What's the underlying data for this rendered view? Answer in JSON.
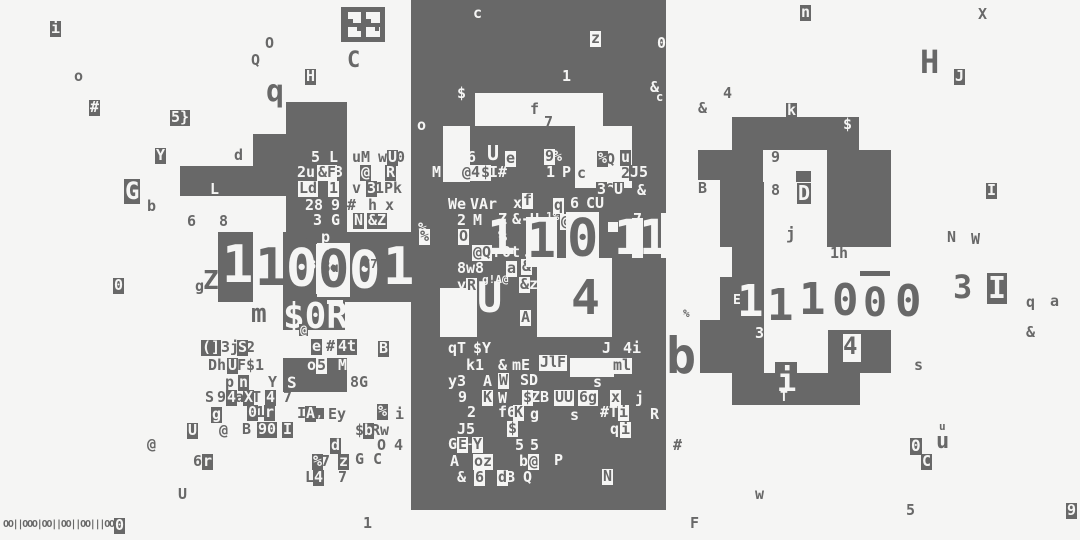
{
  "title": "glitch-terminal-art",
  "colors": {
    "ink": "#686868",
    "paper": "#f5f5f4"
  },
  "barcode": {
    "text": "OO||OOO|OO||OO||OO|||OOO"
  },
  "blocks": [
    [
      341,
      7,
      44,
      35
    ],
    [
      286,
      102,
      61,
      130
    ],
    [
      253,
      134,
      33,
      62
    ],
    [
      180,
      166,
      103,
      30
    ],
    [
      218,
      232,
      35,
      70
    ],
    [
      283,
      232,
      137,
      70
    ],
    [
      283,
      302,
      62,
      28
    ],
    [
      283,
      358,
      64,
      34
    ],
    [
      411,
      0,
      255,
      510
    ],
    [
      732,
      117,
      127,
      33
    ],
    [
      720,
      150,
      43,
      32
    ],
    [
      827,
      150,
      64,
      32
    ],
    [
      796,
      171,
      15,
      11
    ],
    [
      720,
      182,
      44,
      120
    ],
    [
      827,
      182,
      64,
      65
    ],
    [
      734,
      278,
      29,
      46
    ],
    [
      720,
      302,
      44,
      71
    ],
    [
      828,
      330,
      63,
      43
    ],
    [
      732,
      373,
      128,
      32
    ],
    [
      700,
      320,
      32,
      53
    ],
    [
      698,
      150,
      22,
      30
    ],
    [
      860,
      271,
      30,
      5
    ],
    [
      775,
      362,
      22,
      14
    ]
  ],
  "lights": [
    [
      348,
      12,
      13,
      11
    ],
    [
      366,
      12,
      14,
      11
    ],
    [
      348,
      27,
      13,
      10
    ],
    [
      366,
      27,
      14,
      10
    ],
    [
      316,
      244,
      28,
      50
    ],
    [
      327,
      300,
      16,
      4
    ],
    [
      475,
      93,
      128,
      33
    ],
    [
      443,
      126,
      27,
      56
    ],
    [
      575,
      126,
      57,
      62
    ],
    [
      440,
      288,
      37,
      49
    ],
    [
      537,
      258,
      75,
      79
    ],
    [
      632,
      218,
      11,
      40
    ],
    [
      608,
      222,
      10,
      10
    ],
    [
      570,
      358,
      44,
      19
    ],
    [
      661,
      213,
      6,
      45
    ],
    [
      720,
      247,
      12,
      30
    ],
    [
      843,
      334,
      18,
      28
    ]
  ],
  "overblocks": [
    [
      348,
      19,
      5,
      4
    ],
    [
      366,
      19,
      5,
      4
    ],
    [
      357,
      27,
      4,
      4
    ],
    [
      375,
      27,
      4,
      4
    ]
  ],
  "glyphs": [
    [
      50,
      21,
      "i",
      "i"
    ],
    [
      74,
      69,
      "o",
      "d"
    ],
    [
      89,
      100,
      "#",
      "i"
    ],
    [
      170,
      110,
      "5}",
      "i"
    ],
    [
      155,
      148,
      "Y",
      "i"
    ],
    [
      124,
      179,
      "G",
      "i",
      24
    ],
    [
      147,
      199,
      "b",
      "d"
    ],
    [
      234,
      148,
      "d",
      "d"
    ],
    [
      187,
      214,
      "6",
      "d"
    ],
    [
      219,
      214,
      "8",
      "d"
    ],
    [
      265,
      36,
      "O",
      "d"
    ],
    [
      251,
      53,
      "Q",
      "d"
    ],
    [
      305,
      69,
      "H",
      "i"
    ],
    [
      266,
      76,
      "q",
      "d",
      30
    ],
    [
      347,
      50,
      "C",
      "d",
      22
    ],
    [
      113,
      278,
      "0",
      "i"
    ],
    [
      195,
      279,
      "g",
      "d"
    ],
    [
      203,
      268,
      "Z",
      "d",
      26
    ],
    [
      219,
      295,
      "'",
      "d",
      18
    ],
    [
      251,
      301,
      "m",
      "d",
      26
    ],
    [
      201,
      340,
      "(]",
      "i"
    ],
    [
      221,
      340,
      "3j",
      "d"
    ],
    [
      237,
      340,
      "S",
      "i"
    ],
    [
      246,
      340,
      "2",
      "d"
    ],
    [
      311,
      339,
      "e",
      "i"
    ],
    [
      326,
      339,
      "#",
      "d"
    ],
    [
      337,
      339,
      "4t",
      "i"
    ],
    [
      208,
      358,
      "Dh",
      "d"
    ],
    [
      227,
      358,
      "U",
      "i"
    ],
    [
      237,
      358,
      "F$1",
      "d"
    ],
    [
      225,
      375,
      "p",
      "d"
    ],
    [
      238,
      375,
      "n",
      "i"
    ],
    [
      268,
      375,
      "Y",
      "d"
    ],
    [
      205,
      390,
      "S",
      "d"
    ],
    [
      217,
      390,
      "9",
      "d"
    ],
    [
      226,
      390,
      "4",
      "i"
    ],
    [
      235,
      390,
      "a",
      "d"
    ],
    [
      243,
      390,
      "X",
      "i"
    ],
    [
      252,
      390,
      "T",
      "d"
    ],
    [
      265,
      390,
      "4",
      "i"
    ],
    [
      283,
      390,
      "7",
      "d"
    ],
    [
      211,
      407,
      "g",
      "i"
    ],
    [
      247,
      405,
      "0",
      "i"
    ],
    [
      256,
      405,
      "1",
      "d"
    ],
    [
      264,
      405,
      "r",
      "i"
    ],
    [
      297,
      406,
      "I",
      "d"
    ],
    [
      305,
      406,
      "A",
      "i"
    ],
    [
      315,
      408,
      ",",
      "i",
      11
    ],
    [
      328,
      407,
      "Ey",
      "d"
    ],
    [
      377,
      404,
      "%",
      "i"
    ],
    [
      395,
      407,
      "i",
      "d"
    ],
    [
      187,
      423,
      "U",
      "i"
    ],
    [
      219,
      423,
      "@",
      "d"
    ],
    [
      242,
      422,
      "B",
      "d"
    ],
    [
      257,
      422,
      "90",
      "i"
    ],
    [
      282,
      422,
      "I",
      "i"
    ],
    [
      355,
      423,
      "$",
      "d"
    ],
    [
      363,
      423,
      "b",
      "i"
    ],
    [
      371,
      423,
      "Rw",
      "d"
    ],
    [
      147,
      437,
      "@",
      "d"
    ],
    [
      330,
      438,
      "d",
      "i"
    ],
    [
      377,
      438,
      "O",
      "d"
    ],
    [
      394,
      438,
      "4",
      "d"
    ],
    [
      193,
      454,
      "6",
      "d"
    ],
    [
      202,
      454,
      "r",
      "i"
    ],
    [
      312,
      454,
      "%",
      "i"
    ],
    [
      321,
      454,
      "7",
      "d"
    ],
    [
      338,
      454,
      "z",
      "i"
    ],
    [
      355,
      452,
      "G",
      "d"
    ],
    [
      373,
      452,
      "C",
      "d"
    ],
    [
      305,
      470,
      "L",
      "d"
    ],
    [
      313,
      470,
      "4",
      "i"
    ],
    [
      338,
      470,
      "7",
      "d"
    ],
    [
      178,
      487,
      "U",
      "d"
    ],
    [
      363,
      516,
      "1",
      "d"
    ],
    [
      690,
      516,
      "F",
      "d"
    ],
    [
      114,
      518,
      "0",
      "i"
    ],
    [
      307,
      358,
      "o",
      "w"
    ],
    [
      316,
      358,
      "5",
      "b"
    ],
    [
      338,
      358,
      "M",
      "w"
    ],
    [
      287,
      375,
      "S",
      "w",
      16
    ],
    [
      350,
      375,
      "8G",
      "d"
    ],
    [
      378,
      341,
      "B",
      "i"
    ],
    [
      210,
      182,
      "L",
      "w"
    ],
    [
      311,
      150,
      "5 L",
      "w"
    ],
    [
      352,
      150,
      "uM",
      "d"
    ],
    [
      378,
      150,
      "w",
      "d"
    ],
    [
      387,
      150,
      "U",
      "i"
    ],
    [
      396,
      150,
      "0",
      "d"
    ],
    [
      297,
      165,
      "2u",
      "w"
    ],
    [
      317,
      165,
      "&F",
      "b"
    ],
    [
      334,
      165,
      "3",
      "w"
    ],
    [
      360,
      165,
      "@",
      "i"
    ],
    [
      385,
      165,
      "R",
      "i"
    ],
    [
      298,
      181,
      "Ld",
      "b"
    ],
    [
      328,
      181,
      "1",
      "b"
    ],
    [
      352,
      181,
      "v",
      "d"
    ],
    [
      366,
      181,
      "3",
      "i"
    ],
    [
      375,
      181,
      "1Pk",
      "d"
    ],
    [
      305,
      198,
      "28",
      "w"
    ],
    [
      331,
      198,
      "9",
      "w"
    ],
    [
      347,
      198,
      "#",
      "d"
    ],
    [
      368,
      198,
      "h",
      "d"
    ],
    [
      385,
      198,
      "x",
      "d"
    ],
    [
      313,
      213,
      "3",
      "w"
    ],
    [
      331,
      213,
      "G",
      "w"
    ],
    [
      353,
      213,
      "N",
      "i"
    ],
    [
      367,
      213,
      "&Z",
      "i"
    ],
    [
      303,
      229,
      "b",
      "d"
    ],
    [
      320,
      230,
      "p",
      "i"
    ],
    [
      393,
      230,
      "c",
      "d"
    ],
    [
      417,
      221,
      "%",
      "i"
    ],
    [
      222,
      238,
      "1",
      "w",
      52
    ],
    [
      255,
      241,
      "1",
      "d",
      52
    ],
    [
      286,
      242,
      "0",
      "w",
      52
    ],
    [
      317,
      243,
      "0",
      "b",
      52
    ],
    [
      349,
      244,
      "0",
      "w",
      52
    ],
    [
      383,
      240,
      "1",
      "w",
      52
    ],
    [
      318,
      247,
      "c\"",
      "w",
      10
    ],
    [
      309,
      259,
      "3",
      "w",
      12
    ],
    [
      321,
      259,
      "8",
      "d",
      16
    ],
    [
      331,
      262,
      "u",
      "d",
      13
    ],
    [
      363,
      258,
      "C7",
      "d",
      12
    ],
    [
      283,
      298,
      "$0R",
      "w",
      36
    ],
    [
      299,
      324,
      "@",
      "i",
      12
    ],
    [
      473,
      6,
      "c",
      "w"
    ],
    [
      590,
      31,
      "z",
      "b"
    ],
    [
      657,
      36,
      "0",
      "w"
    ],
    [
      562,
      69,
      "1",
      "w"
    ],
    [
      457,
      86,
      "$",
      "w"
    ],
    [
      650,
      80,
      "&",
      "w"
    ],
    [
      656,
      91,
      "c",
      "w",
      12
    ],
    [
      530,
      102,
      "f",
      "d"
    ],
    [
      544,
      115,
      "7",
      "d"
    ],
    [
      417,
      118,
      "o",
      "w"
    ],
    [
      432,
      165,
      "M",
      "w"
    ],
    [
      467,
      150,
      "6",
      "w"
    ],
    [
      487,
      143,
      "U",
      "w",
      20
    ],
    [
      505,
      151,
      "e",
      "b"
    ],
    [
      461,
      165,
      "@4",
      "b"
    ],
    [
      480,
      165,
      "$",
      "b"
    ],
    [
      489,
      165,
      "I#",
      "w"
    ],
    [
      544,
      149,
      "9",
      "b"
    ],
    [
      553,
      149,
      "%",
      "w"
    ],
    [
      546,
      165,
      "1",
      "w"
    ],
    [
      562,
      165,
      "P",
      "w"
    ],
    [
      577,
      166,
      "c",
      "d"
    ],
    [
      597,
      151,
      "%",
      "i"
    ],
    [
      606,
      152,
      "Q",
      "d"
    ],
    [
      620,
      150,
      "u",
      "i"
    ],
    [
      621,
      166,
      "2",
      "d"
    ],
    [
      629,
      165,
      "J",
      "i"
    ],
    [
      638,
      165,
      "5",
      "i"
    ],
    [
      596,
      182,
      "3",
      "i"
    ],
    [
      605,
      182,
      "6",
      "d"
    ],
    [
      613,
      182,
      "U",
      "i"
    ],
    [
      637,
      183,
      "&",
      "w"
    ],
    [
      698,
      181,
      "B",
      "d"
    ],
    [
      448,
      197,
      "We",
      "w"
    ],
    [
      470,
      197,
      "VAr",
      "w"
    ],
    [
      513,
      196,
      "x",
      "w"
    ],
    [
      522,
      193,
      "f",
      "b"
    ],
    [
      553,
      198,
      "q",
      "b"
    ],
    [
      570,
      196,
      "6",
      "w"
    ],
    [
      585,
      196,
      "C",
      "i"
    ],
    [
      594,
      196,
      "U",
      "i"
    ],
    [
      604,
      193,
      "N",
      "d",
      12
    ],
    [
      457,
      213,
      "2",
      "w"
    ],
    [
      473,
      213,
      "M",
      "w"
    ],
    [
      498,
      212,
      "Z",
      "w"
    ],
    [
      512,
      212,
      "&-U",
      "w"
    ],
    [
      546,
      211,
      "1%",
      "w",
      11
    ],
    [
      560,
      214,
      "@",
      "b"
    ],
    [
      633,
      212,
      "7",
      "w"
    ],
    [
      458,
      229,
      "O",
      "b"
    ],
    [
      498,
      229,
      "%",
      "w"
    ],
    [
      528,
      228,
      "Z",
      "b"
    ],
    [
      419,
      229,
      "%",
      "b"
    ],
    [
      472,
      245,
      "@Q",
      "b"
    ],
    [
      493,
      245,
      "r0t",
      "w"
    ],
    [
      523,
      248,
      "-",
      "w"
    ],
    [
      537,
      244,
      "k",
      "w"
    ],
    [
      457,
      261,
      "8w8",
      "w"
    ],
    [
      506,
      261,
      "a",
      "b"
    ],
    [
      521,
      259,
      "&",
      "b"
    ],
    [
      457,
      278,
      "y",
      "w"
    ],
    [
      466,
      278,
      "R",
      "b"
    ],
    [
      482,
      274,
      "g!A@",
      "w",
      11
    ],
    [
      519,
      277,
      "&",
      "b"
    ],
    [
      529,
      277,
      "z9",
      "w"
    ],
    [
      520,
      310,
      "A",
      "b"
    ],
    [
      477,
      276,
      "U",
      "w",
      42
    ],
    [
      487,
      214,
      "1",
      "w",
      48
    ],
    [
      526,
      217,
      "1",
      "b",
      48
    ],
    [
      566,
      212,
      "0",
      "b",
      52
    ],
    [
      614,
      214,
      "1",
      "w",
      48
    ],
    [
      639,
      214,
      "1",
      "w",
      48
    ],
    [
      571,
      274,
      "4",
      "d",
      48
    ],
    [
      448,
      341,
      "qT",
      "w"
    ],
    [
      473,
      341,
      "$Y",
      "w"
    ],
    [
      602,
      341,
      "J",
      "w"
    ],
    [
      623,
      341,
      "4i",
      "w"
    ],
    [
      539,
      355,
      "Jl",
      "b"
    ],
    [
      556,
      355,
      "F",
      "b"
    ],
    [
      466,
      358,
      "k1",
      "w"
    ],
    [
      498,
      358,
      "&",
      "w"
    ],
    [
      512,
      358,
      "mE",
      "w"
    ],
    [
      600,
      358,
      "2",
      "w"
    ],
    [
      612,
      358,
      "ml",
      "b"
    ],
    [
      448,
      374,
      "y3",
      "w"
    ],
    [
      483,
      374,
      "A",
      "w"
    ],
    [
      498,
      373,
      "W",
      "b"
    ],
    [
      520,
      373,
      "SD",
      "w"
    ],
    [
      593,
      375,
      "s",
      "w"
    ],
    [
      458,
      390,
      "9",
      "w"
    ],
    [
      482,
      390,
      "K",
      "b"
    ],
    [
      498,
      391,
      "W",
      "w"
    ],
    [
      522,
      390,
      "$",
      "b"
    ],
    [
      531,
      390,
      "ZB",
      "w"
    ],
    [
      554,
      390,
      "UU",
      "b"
    ],
    [
      578,
      390,
      "6g",
      "b"
    ],
    [
      610,
      390,
      "x",
      "b"
    ],
    [
      635,
      391,
      "j",
      "w"
    ],
    [
      467,
      405,
      "2",
      "w"
    ],
    [
      498,
      405,
      "f6",
      "w"
    ],
    [
      513,
      405,
      "K",
      "b"
    ],
    [
      530,
      407,
      "g",
      "w"
    ],
    [
      570,
      408,
      "s",
      "w"
    ],
    [
      600,
      405,
      "#T",
      "w"
    ],
    [
      618,
      405,
      "i",
      "b"
    ],
    [
      650,
      407,
      "R",
      "w"
    ],
    [
      457,
      422,
      "J5",
      "w"
    ],
    [
      507,
      421,
      "$",
      "b"
    ],
    [
      610,
      422,
      "q",
      "w"
    ],
    [
      620,
      422,
      "i",
      "b"
    ],
    [
      448,
      437,
      "G",
      "w"
    ],
    [
      457,
      437,
      "E",
      "b"
    ],
    [
      467,
      440,
      "-",
      "w",
      10
    ],
    [
      472,
      437,
      "Y",
      "b"
    ],
    [
      515,
      438,
      "5",
      "w"
    ],
    [
      530,
      438,
      "5",
      "w"
    ],
    [
      450,
      454,
      "A",
      "w"
    ],
    [
      473,
      454,
      "oz",
      "b"
    ],
    [
      519,
      454,
      "b",
      "w"
    ],
    [
      528,
      454,
      "@",
      "b"
    ],
    [
      554,
      453,
      "P",
      "w"
    ],
    [
      457,
      470,
      "&",
      "w"
    ],
    [
      474,
      470,
      "6",
      "b"
    ],
    [
      497,
      470,
      "d",
      "b"
    ],
    [
      506,
      470,
      "B",
      "w"
    ],
    [
      523,
      470,
      "Q",
      "w"
    ],
    [
      602,
      469,
      "N",
      "b"
    ],
    [
      800,
      5,
      "n",
      "i"
    ],
    [
      978,
      7,
      "X",
      "d"
    ],
    [
      920,
      46,
      "H",
      "d",
      32
    ],
    [
      954,
      69,
      "J",
      "i"
    ],
    [
      723,
      86,
      "4",
      "d"
    ],
    [
      786,
      103,
      "k",
      "i"
    ],
    [
      843,
      117,
      "$",
      "w"
    ],
    [
      698,
      101,
      "&",
      "d"
    ],
    [
      683,
      308,
      "%",
      "d",
      11
    ],
    [
      666,
      330,
      "b",
      "d",
      50
    ],
    [
      673,
      438,
      "#",
      "d"
    ],
    [
      947,
      230,
      "N",
      "d"
    ],
    [
      971,
      232,
      "W",
      "d"
    ],
    [
      986,
      183,
      "I",
      "i"
    ],
    [
      953,
      271,
      "3",
      "d",
      32
    ],
    [
      987,
      273,
      "I",
      "i",
      30
    ],
    [
      1026,
      295,
      "q",
      "d"
    ],
    [
      1050,
      294,
      "a",
      "d"
    ],
    [
      1026,
      325,
      "&",
      "d"
    ],
    [
      914,
      358,
      "s",
      "d"
    ],
    [
      939,
      421,
      "u",
      "d",
      11
    ],
    [
      910,
      438,
      "0",
      "i",
      16
    ],
    [
      936,
      431,
      "u",
      "d",
      22
    ],
    [
      921,
      454,
      "C",
      "i"
    ],
    [
      755,
      487,
      "w",
      "d"
    ],
    [
      906,
      503,
      "5",
      "d"
    ],
    [
      1066,
      503,
      "9",
      "i"
    ],
    [
      770,
      150,
      "9",
      "b"
    ],
    [
      771,
      183,
      "8",
      "d"
    ],
    [
      797,
      183,
      "D",
      "i",
      20
    ],
    [
      786,
      226,
      "j",
      "d",
      16
    ],
    [
      830,
      246,
      "1h",
      "d"
    ],
    [
      733,
      294,
      "E",
      "w",
      13
    ],
    [
      737,
      279,
      "1",
      "w",
      44
    ],
    [
      767,
      283,
      "1",
      "d",
      44
    ],
    [
      799,
      277,
      "1",
      "d",
      44
    ],
    [
      831,
      278,
      "0",
      "b",
      44
    ],
    [
      862,
      283,
      "0",
      "b",
      40
    ],
    [
      894,
      279,
      "0",
      "b",
      44
    ],
    [
      755,
      326,
      "3",
      "w"
    ],
    [
      843,
      334,
      "4",
      "d",
      24
    ],
    [
      777,
      364,
      "i",
      "w",
      32
    ],
    [
      780,
      391,
      "T",
      "w",
      13
    ]
  ]
}
